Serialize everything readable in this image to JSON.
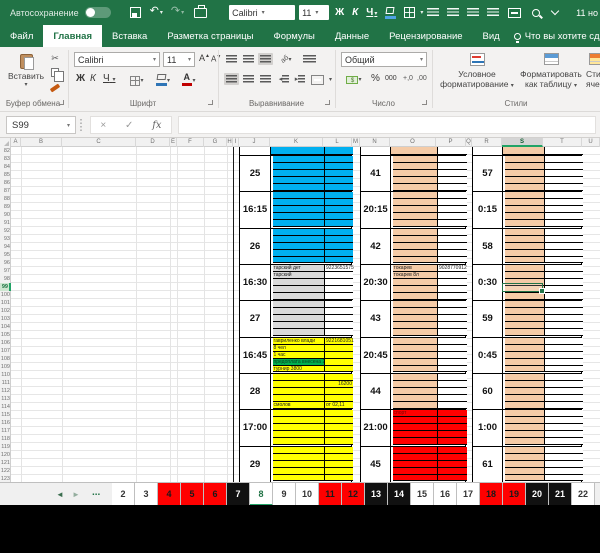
{
  "titlebar": {
    "autosave": "Автосохранение",
    "doc_title": "11 но",
    "font": "Calibri",
    "size": "11",
    "bold": "Ж",
    "italic": "К",
    "underline": "Ч"
  },
  "ribbon_tabs": [
    {
      "label": "Файл",
      "active": false
    },
    {
      "label": "Главная",
      "active": true
    },
    {
      "label": "Вставка",
      "active": false
    },
    {
      "label": "Разметка страницы",
      "active": false
    },
    {
      "label": "Формулы",
      "active": false
    },
    {
      "label": "Данные",
      "active": false
    },
    {
      "label": "Рецензирование",
      "active": false
    },
    {
      "label": "Вид",
      "active": false
    }
  ],
  "tellme": "Что вы хотите сделать?",
  "ribbon": {
    "paste": "Вставить",
    "clipboard_group": "Буфер обмена",
    "font_group": "Шрифт",
    "align_group": "Выравнивание",
    "number_group": "Число",
    "styles_group": "Стили",
    "font": "Calibri",
    "size": "11",
    "bold": "Ж",
    "italic": "К",
    "underline": "Ч",
    "number_format": "Общий",
    "percent": "%",
    "thousands": "000",
    "dec_inc": "+,0",
    "dec_dec": ",00",
    "conditional_1": "Условное",
    "conditional_2": "форматирование",
    "format_table_1": "Форматировать",
    "format_table_2": "как таблицу",
    "cell_styles_1": "Сти",
    "cell_styles_2": "ячее"
  },
  "formula_bar": {
    "name_box": "S99",
    "cancel": "×",
    "enter": "✓",
    "fx": "fx",
    "value": ""
  },
  "grid": {
    "columns": [
      "A",
      "B",
      "C",
      "D",
      "E",
      "F",
      "G",
      "H",
      "I",
      "J",
      "K",
      "L",
      "M",
      "N",
      "O",
      "P",
      "Q",
      "R",
      "S",
      "T",
      "U"
    ],
    "selected_column": "S",
    "first_row": 82,
    "visible_rows": 42,
    "selected_row": 99,
    "selected_cell": "S99"
  },
  "colors": {
    "blue": "#00B0F0",
    "yellow": "#FFFF00",
    "red": "#FF0000",
    "peach": "#F5CBA7",
    "gray": "#D9D9D9",
    "green": "#00B050",
    "white": "#FFFFFF",
    "excel_green": "#217346"
  },
  "schedule": {
    "sections": [
      {
        "name": "afternoon",
        "pre_k": "blue",
        "pre_l": "blue",
        "slots": [
          {
            "label": "25",
            "k": "blue",
            "l": "blue"
          },
          {
            "label": "16:15",
            "k": "blue",
            "l": "blue"
          },
          {
            "label": "26",
            "k": "blue",
            "l": "blue"
          },
          {
            "label": "16:30",
            "k": "gray",
            "l": "white",
            "texts": [
              {
                "c": "k",
                "r": 0,
                "t": "тарский дет"
              },
              {
                "c": "l",
                "r": 0,
                "t": "9223651575",
                "al": "r"
              },
              {
                "c": "k",
                "r": 1,
                "t": "тарский"
              }
            ]
          },
          {
            "label": "27",
            "k": "gray",
            "l": "white"
          },
          {
            "label": "16:45",
            "k": "yellow",
            "l": "yellow",
            "texts": [
              {
                "c": "k",
                "r": 0,
                "t": "гавриленко влади"
              },
              {
                "c": "l",
                "r": 0,
                "t": "9221681051",
                "al": "r"
              },
              {
                "c": "k",
                "r": 1,
                "t": "8 чел"
              },
              {
                "c": "k",
                "r": 2,
                "t": "1 час"
              },
              {
                "c": "k",
                "r": 3,
                "t": "предоплата внесена 2000",
                "bg": "green"
              },
              {
                "c": "k",
                "r": 4,
                "t": "турнир 3800"
              }
            ]
          },
          {
            "label": "28",
            "k": "yellow",
            "l": "yellow",
            "texts": [
              {
                "c": "l",
                "r": 1,
                "t": "16200",
                "al": "r"
              },
              {
                "c": "k",
                "r": 4,
                "t": "смолов"
              },
              {
                "c": "l",
                "r": 4,
                "t": "от 02,11"
              }
            ]
          },
          {
            "label": "17:00",
            "k": "yellow",
            "l": "yellow"
          },
          {
            "label": "29",
            "k": "yellow",
            "l": "yellow"
          }
        ]
      },
      {
        "name": "evening",
        "pre_k": "peach",
        "pre_l": "white",
        "slots": [
          {
            "label": "41",
            "k": "peach",
            "l": "white"
          },
          {
            "label": "20:15",
            "k": "peach",
            "l": "white"
          },
          {
            "label": "42",
            "k": "peach",
            "l": "white"
          },
          {
            "label": "20:30",
            "k": "peach",
            "l": "white",
            "texts": [
              {
                "c": "k",
                "r": 0,
                "t": "токарев"
              },
              {
                "c": "l",
                "r": 0,
                "t": "9028770912",
                "al": "r"
              },
              {
                "c": "k",
                "r": 1,
                "t": "токарев 8л"
              }
            ]
          },
          {
            "label": "43",
            "k": "peach",
            "l": "white"
          },
          {
            "label": "20:45",
            "k": "peach",
            "l": "white"
          },
          {
            "label": "44",
            "k": "peach",
            "l": "white"
          },
          {
            "label": "21:00",
            "k": "red",
            "l": "red",
            "texts": [
              {
                "c": "k",
                "r": 0,
                "t": "спорт",
                "dark": true
              }
            ]
          },
          {
            "label": "45",
            "k": "red",
            "l": "red"
          }
        ]
      },
      {
        "name": "night",
        "pre_k": "peach",
        "pre_l": "white",
        "slots": [
          {
            "label": "57",
            "k": "peach",
            "l": "white"
          },
          {
            "label": "0:15",
            "k": "peach",
            "l": "white"
          },
          {
            "label": "58",
            "k": "peach",
            "l": "white"
          },
          {
            "label": "0:30",
            "k": "peach",
            "l": "white"
          },
          {
            "label": "59",
            "k": "peach",
            "l": "white"
          },
          {
            "label": "0:45",
            "k": "peach",
            "l": "white"
          },
          {
            "label": "60",
            "k": "peach",
            "l": "white"
          },
          {
            "label": "1:00",
            "k": "peach",
            "l": "white"
          },
          {
            "label": "61",
            "k": "peach",
            "l": "white"
          }
        ]
      }
    ]
  },
  "sheet_tabs": {
    "nav_prev": "◄",
    "nav_next": "►",
    "ellipsis": "...",
    "tabs": [
      {
        "label": "2",
        "style": "white"
      },
      {
        "label": "3",
        "style": "white"
      },
      {
        "label": "4",
        "style": "red"
      },
      {
        "label": "5",
        "style": "red"
      },
      {
        "label": "6",
        "style": "red"
      },
      {
        "label": "7",
        "style": "black"
      },
      {
        "label": "8",
        "style": "active"
      },
      {
        "label": "9",
        "style": "white"
      },
      {
        "label": "10",
        "style": "white"
      },
      {
        "label": "11",
        "style": "red"
      },
      {
        "label": "12",
        "style": "red"
      },
      {
        "label": "13",
        "style": "black"
      },
      {
        "label": "14",
        "style": "black"
      },
      {
        "label": "15",
        "style": "white"
      },
      {
        "label": "16",
        "style": "white"
      },
      {
        "label": "17",
        "style": "white"
      },
      {
        "label": "18",
        "style": "red"
      },
      {
        "label": "19",
        "style": "red"
      },
      {
        "label": "20",
        "style": "black"
      },
      {
        "label": "21",
        "style": "black"
      },
      {
        "label": "22",
        "style": "white"
      }
    ]
  }
}
